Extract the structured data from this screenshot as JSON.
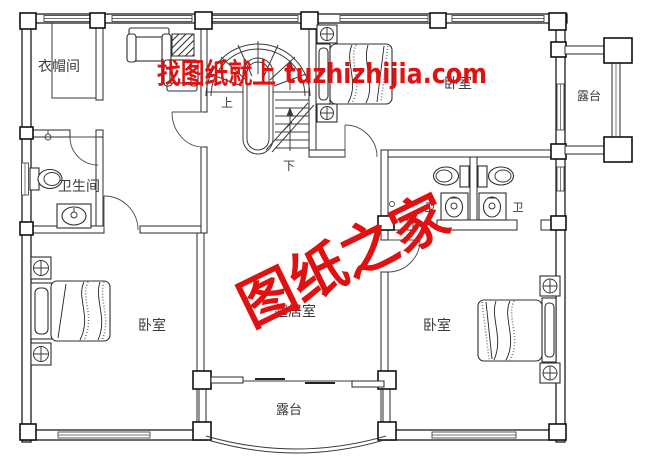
{
  "watermark": {
    "top_text": "找图纸就上 tuzhizhijia.com",
    "center_text": "图纸之家",
    "color": "#e01111"
  },
  "labels": {
    "cloakroom": "衣帽间",
    "bathroom": "卫生间",
    "bedroom_left": "卧室",
    "bedroom_top_right": "卧室",
    "bedroom_bottom_right": "卧室",
    "living_room": "起居室",
    "terrace_right": "露台",
    "terrace_bottom": "露台",
    "wc_left": "卫",
    "wc_right": "卫",
    "stairs_up": "上",
    "stairs_down": "下"
  },
  "colors": {
    "background": "#ffffff",
    "wall_line": "#1c1c1c",
    "thin_line": "#3a3a3a",
    "watermark_red": "#e01111"
  }
}
